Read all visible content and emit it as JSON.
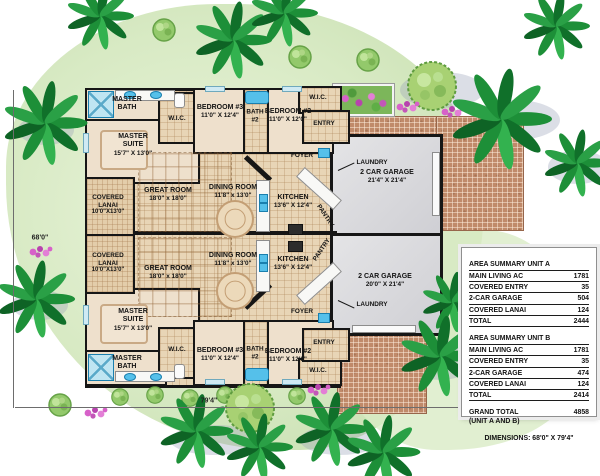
{
  "site": {
    "width_dim": "79'4\"",
    "height_dim": "68'0\""
  },
  "a": {
    "master_bath": {
      "n": "MASTER",
      "n2": "BATH"
    },
    "master_suite": {
      "n": "MASTER",
      "n2": "SUITE",
      "d": "15'7\" X 13'0\""
    },
    "wic_master": {
      "n": "W.I.C."
    },
    "bedroom3": {
      "n": "BEDROOM #3",
      "d": "11'0\" X 12'4\""
    },
    "bath2": {
      "n": "BATH",
      "n2": "#2"
    },
    "bedroom2": {
      "n": "BEDROOM #2",
      "d": "11'0\" X 12'0\""
    },
    "wic_bed2": {
      "n": "W.I.C."
    },
    "entry": {
      "n": "ENTRY"
    },
    "foyer": {
      "n": "FOYER"
    },
    "laundry": {
      "n": "LAUNDRY"
    },
    "pantry": {
      "n": "PANTRY"
    },
    "kitchen": {
      "n": "KITCHEN",
      "d": "13'6\" X 12'4\""
    },
    "dining": {
      "n": "DINING ROOM",
      "d": "11'8\" x 13'0\""
    },
    "great": {
      "n": "GREAT ROOM",
      "d": "18'0\" x 18'0\""
    },
    "lanai": {
      "n": "COVERED",
      "n2": "LANAI",
      "d": "10'0\"X13'0\""
    },
    "garage": {
      "n": "2 CAR GARAGE",
      "d": "21'4\" X 21'4\""
    }
  },
  "b": {
    "master_bath": {
      "n": "MASTER",
      "n2": "BATH"
    },
    "master_suite": {
      "n": "MASTER",
      "n2": "SUITE",
      "d": "15'7\" X 13'0\""
    },
    "wic_master": {
      "n": "W.I.C."
    },
    "bedroom3": {
      "n": "BEDROOM #3",
      "d": "11'0\" X 12'4\""
    },
    "bath2": {
      "n": "BATH",
      "n2": "#2"
    },
    "bedroom2": {
      "n": "BEDROOM #2",
      "d": "11'0\" X 12'0\""
    },
    "wic_bed2": {
      "n": "W.I.C."
    },
    "entry": {
      "n": "ENTRY"
    },
    "foyer": {
      "n": "FOYER"
    },
    "laundry": {
      "n": "LAUNDRY"
    },
    "pantry": {
      "n": "PANTRY"
    },
    "kitchen": {
      "n": "KITCHEN",
      "d": "13'6\" X 12'4\""
    },
    "dining": {
      "n": "DINING ROOM",
      "d": "11'8\" x 13'0\""
    },
    "great": {
      "n": "GREAT ROOM",
      "d": "18'0\" x 18'0\""
    },
    "lanai": {
      "n": "COVERED",
      "n2": "LANAI",
      "d": "10'0\"X13'0\""
    },
    "garage": {
      "n": "2 CAR GARAGE",
      "d": "20'0\" X 21'4\""
    }
  },
  "table": {
    "a_title": "AREA SUMMARY UNIT A",
    "a_rows": [
      [
        "MAIN LIVING AC",
        "1781"
      ],
      [
        "COVERED ENTRY",
        "35"
      ],
      [
        "2-CAR GARAGE",
        "504"
      ],
      [
        "COVERED LANAI",
        "124"
      ],
      [
        "TOTAL",
        "2444"
      ]
    ],
    "b_title": "AREA SUMMARY UNIT B",
    "b_rows": [
      [
        "MAIN LIVING AC",
        "1781"
      ],
      [
        "COVERED ENTRY",
        "35"
      ],
      [
        "2-CAR GARAGE",
        "474"
      ],
      [
        "COVERED LANAI",
        "124"
      ],
      [
        "TOTAL",
        "2414"
      ]
    ],
    "grand_label": "GRAND TOTAL",
    "grand_value": "4858",
    "grand_sub": "(UNIT A AND B)",
    "dims_line": "DIMENSIONS: 68'0\" X 79'4\""
  },
  "colors": {
    "lawn": "#d8eac4",
    "brick": "#c08a6a",
    "floor_tan": "#e8d5b6",
    "garage_gray": "#d9d9dc",
    "wall": "#161616",
    "palm_green": "#1d8f38",
    "flower_pink": "#d761c9",
    "fixture_blue": "#55c0ea"
  }
}
